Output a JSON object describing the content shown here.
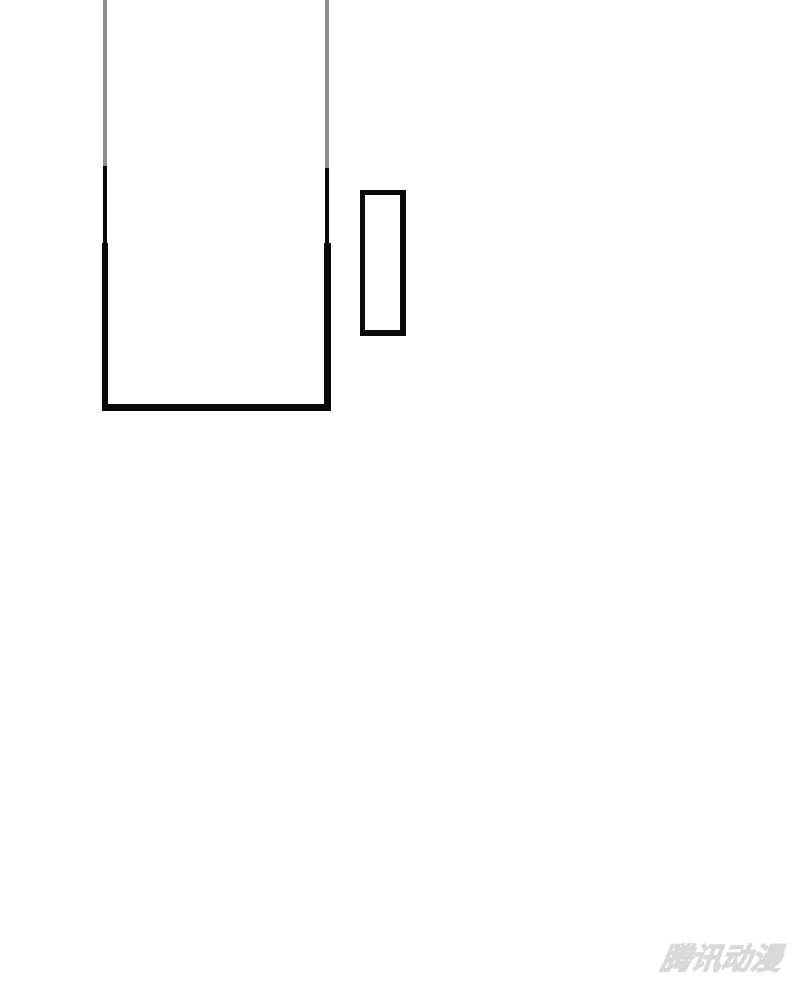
{
  "page": {
    "type": "comic-page-region",
    "background_color": "#ffffff"
  },
  "panels": [
    {
      "id": "large-panel",
      "content": "empty panel, cropped at top edge of view",
      "border_color": "#0a0a0a",
      "faded_border_color": "#8e8e8e"
    },
    {
      "id": "small-panel",
      "content": "empty narrow vertical panel",
      "border_color": "#0a0a0a"
    }
  ],
  "watermark": {
    "text": "腾讯动漫",
    "color": "#d9d9d9"
  }
}
